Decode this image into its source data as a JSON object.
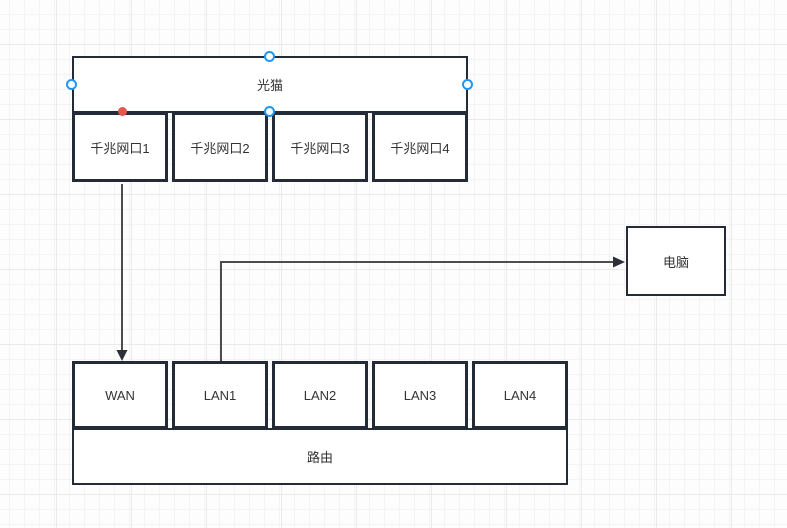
{
  "canvas": {
    "background": "#fdfdfd",
    "grid_minor_color": "#f4f4f4",
    "grid_major_color": "#eaeaea"
  },
  "diagram": {
    "modem": {
      "label": "光猫",
      "ports": [
        "千兆网口1",
        "千兆网口2",
        "千兆网口3",
        "千兆网口4"
      ]
    },
    "router": {
      "label": "路由",
      "ports": [
        "WAN",
        "LAN1",
        "LAN2",
        "LAN3",
        "LAN4"
      ]
    },
    "computer": {
      "label": "电脑"
    },
    "connections": [
      {
        "from": "光猫.千兆网口1",
        "to": "路由.WAN",
        "shape": "straight-down-arrow"
      },
      {
        "from": "路由.LAN1",
        "to": "电脑",
        "shape": "elbow-up-right-arrow"
      }
    ]
  },
  "selection": {
    "selected_shape": "光猫",
    "handle_color": "#2196f3",
    "connection_point_color": "#e8554d"
  },
  "colors": {
    "shape_border": "#232b36",
    "connector_line": "#4d4d4d",
    "arrowhead": "#2b2f38",
    "text": "#333333"
  }
}
